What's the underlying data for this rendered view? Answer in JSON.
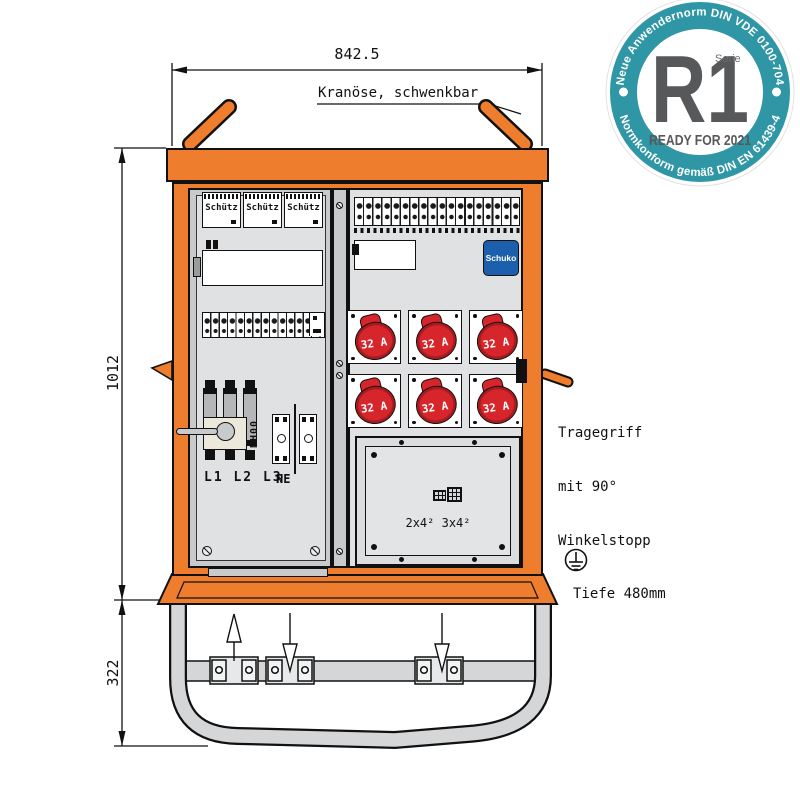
{
  "colors": {
    "orange": "#EE7D2D",
    "socket_red": "#D6252B",
    "schuko_blue": "#1C5FAC",
    "badge_teal": "#2E96A4",
    "badge_gray": "#57585A"
  },
  "dimensions": {
    "width": "842.5",
    "height": "1012",
    "base": "322",
    "depth_note": "Tiefe 480mm"
  },
  "annotations": {
    "crane": "Kranöse, schwenkbar",
    "handle_line1": "Tragegriff",
    "handle_line2": "mit 90°",
    "handle_line3": "Winkelstopp"
  },
  "badge": {
    "arc_top": "Neue Anwendernorm DIN VDE 0100-704",
    "arc_bottom": "Normkonform gemäß DIN EN 61439-4",
    "series": "Serie",
    "code": "R1",
    "ready": "READY FOR 2021"
  },
  "cabinet": {
    "contactors": [
      "Schütz",
      "Schütz",
      "Schütz"
    ],
    "schuko": "Schuko",
    "socket_rating": "32 A",
    "main_switch": {
      "type": "NH00",
      "phases": "L1 L2 L3",
      "neutral": "N",
      "earth": "PE"
    },
    "blank_plate": {
      "cross_sections": "2x4² 3x4²"
    }
  }
}
